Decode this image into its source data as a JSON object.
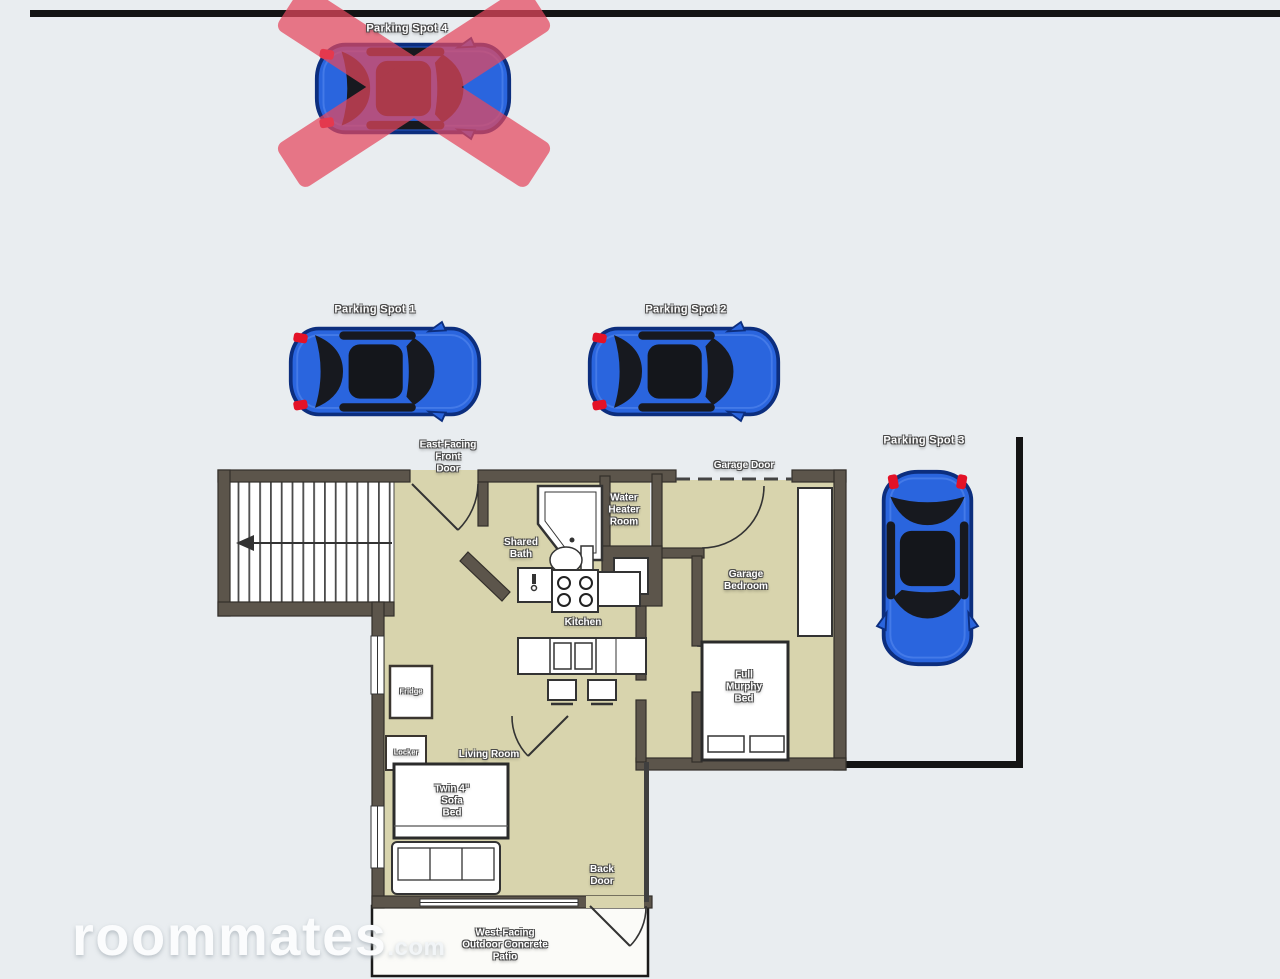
{
  "scene": {
    "type": "apartment floor plan with parking diagram"
  },
  "watermark": {
    "brand": "roommates",
    "tld": ".com"
  },
  "parking": {
    "spot1": {
      "label": "Parking Spot 1"
    },
    "spot2": {
      "label": "Parking Spot 2"
    },
    "spot3": {
      "label": "Parking Spot 3"
    },
    "spot4": {
      "label": "Parking Spot 4",
      "status": "crossed-out"
    }
  },
  "floorplan": {
    "labels": {
      "front_door": "East-Facing\nFront\nDoor",
      "garage_door": "Garage Door",
      "water_heater": "Water\nHeater\nRoom",
      "shared_bath": "Shared\nBath",
      "kitchen": "Kitchen",
      "garage_bedroom": "Garage\nBedroom",
      "murphy_bed": "Full\nMurphy\nBed",
      "living_room": "Living Room",
      "sofa_bed": "Twin 4\"\nSofa\nBed",
      "fridge": "Fridge",
      "locker": "Locker",
      "back_door": "Back\nDoor",
      "patio": "West-Facing\nOutdoor Concrete\nPatio"
    }
  },
  "colors": {
    "background": "#e9edf0",
    "wall": "#5c554b",
    "floor": "#d8d4ad",
    "car_blue": "#2a65de",
    "cross_red": "#e5485e",
    "line_black": "#141414"
  }
}
